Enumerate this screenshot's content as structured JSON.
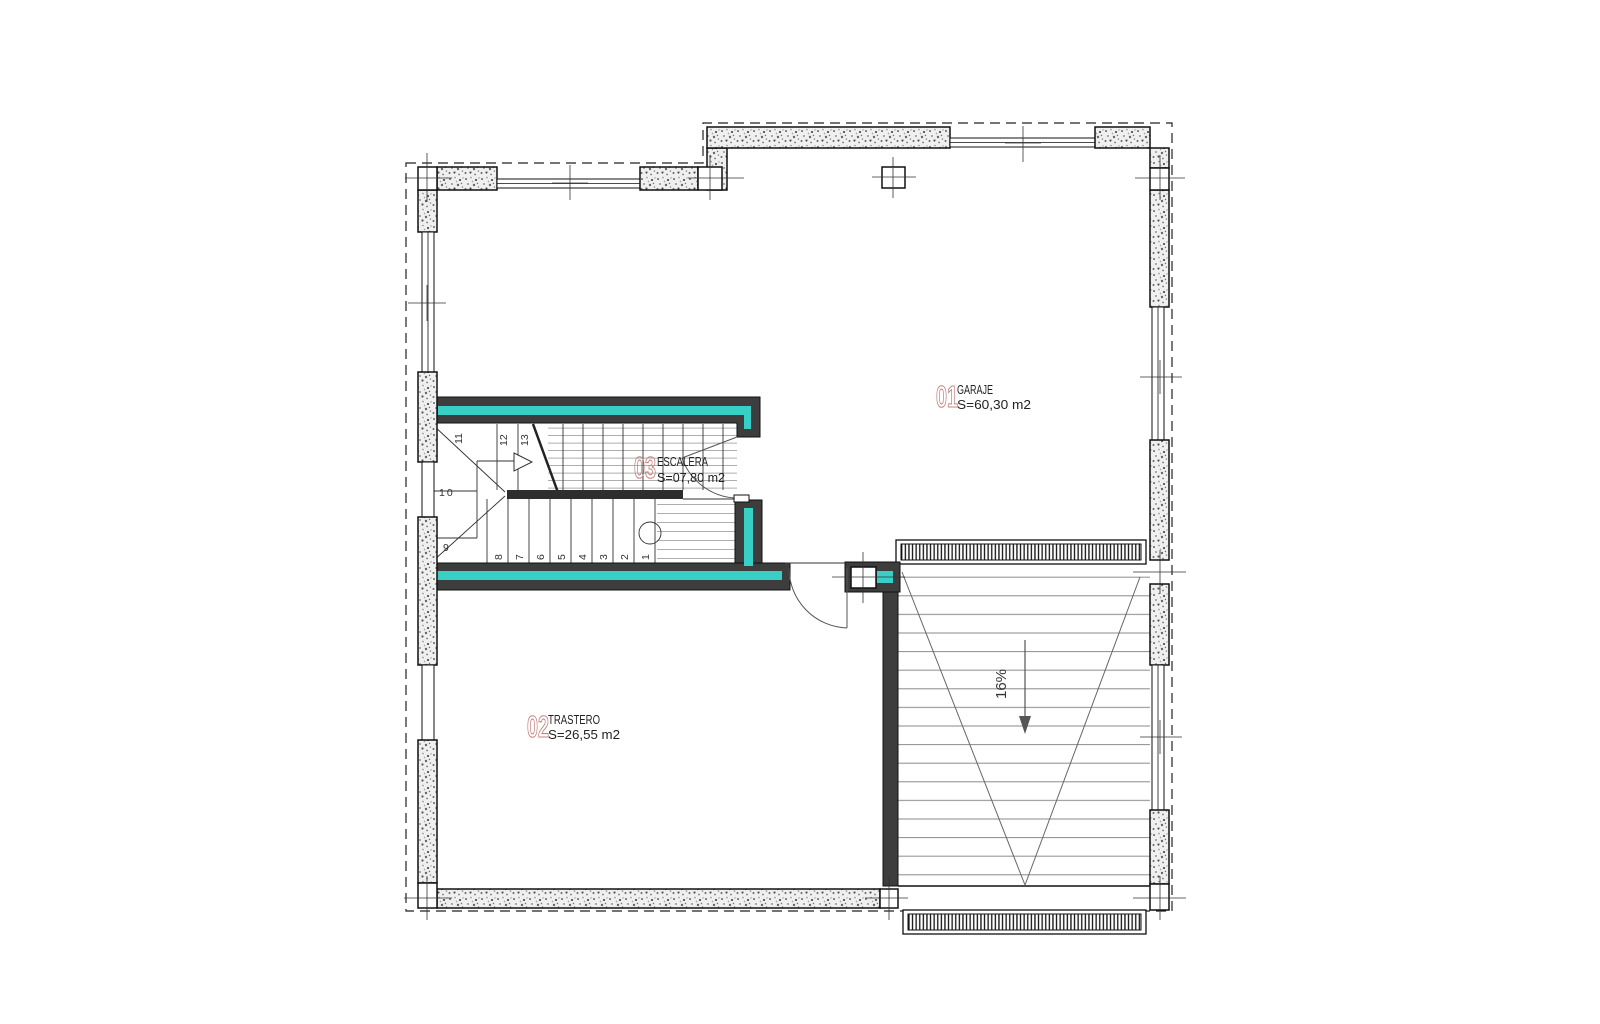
{
  "drawing": {
    "rooms": [
      {
        "number": "01",
        "name": "GARAJE",
        "area": "S=60,30  m2"
      },
      {
        "number": "02",
        "name": "TRASTERO",
        "area": "S=26,55  m2"
      },
      {
        "number": "03",
        "name": "ESCALERA",
        "area": "S=07,80  m2"
      }
    ],
    "ramp": {
      "slope_label": "16%"
    },
    "stair": {
      "steps": [
        "1",
        "2",
        "3",
        "4",
        "5",
        "6",
        "7",
        "8",
        "9",
        "10",
        "11",
        "12",
        "13"
      ]
    },
    "colors": {
      "highlight_wall": "#38cfc7",
      "structure_dark": "#3d3d3d",
      "room_number": "#c3827d"
    }
  }
}
